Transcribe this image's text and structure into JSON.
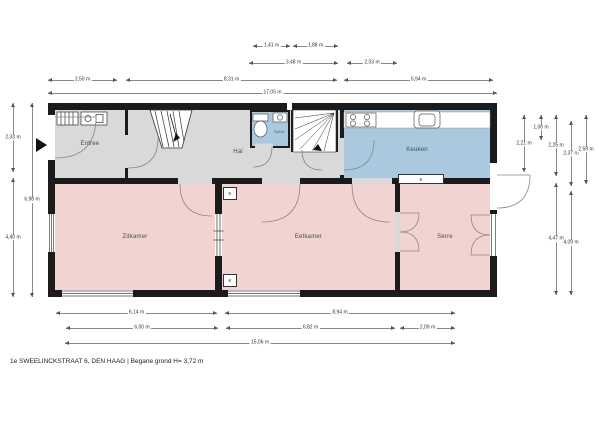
{
  "caption": "1e SWEELINCKSTRAAT 6, DEN HAAG | Begane grond H= 3,72 m",
  "colors": {
    "hall": "#d9d9d9",
    "wet": "#aac9df",
    "living": "#f1d3d1",
    "wall": "#1b1b1b",
    "dim_line": "#888888",
    "dim_text": "#333333",
    "room_text": "#4a4a4a"
  },
  "rooms": [
    {
      "name": "entree",
      "label": "Entree",
      "x": 55,
      "y": 110,
      "w": 70,
      "h": 68,
      "fill": "hall",
      "fs": 6
    },
    {
      "name": "hal",
      "label": "Hal",
      "x": 128,
      "y": 110,
      "w": 212,
      "h": 68,
      "fill": "hall",
      "fs": 6,
      "dx": 4,
      "dy": 8
    },
    {
      "name": "keuken",
      "label": "Keuken",
      "x": 344,
      "y": 110,
      "w": 146,
      "h": 72,
      "fill": "wet",
      "fs": 6,
      "dy": 4
    },
    {
      "name": "toilet",
      "label": "Toilet",
      "x": 250,
      "y": 112,
      "w": 40,
      "h": 35,
      "fill": "wet",
      "fs": 4,
      "dx": 9,
      "dy": 2
    },
    {
      "name": "zitkamer",
      "label": "Zitkamer",
      "x": 55,
      "y": 184,
      "w": 160,
      "h": 106,
      "fill": "living",
      "fs": 6
    },
    {
      "name": "eetkamer",
      "label": "Eetkamer",
      "x": 222,
      "y": 184,
      "w": 173,
      "h": 106,
      "fill": "living",
      "fs": 6
    },
    {
      "name": "serre",
      "label": "Serre",
      "x": 400,
      "y": 184,
      "w": 90,
      "h": 106,
      "fill": "living",
      "fs": 6
    }
  ],
  "markers": [
    {
      "label": "K",
      "x": 398,
      "y": 174,
      "w": 46,
      "h": 10
    },
    {
      "label": "K",
      "x": 223,
      "y": 187,
      "w": 14,
      "h": 13
    },
    {
      "label": "K",
      "x": 223,
      "y": 274,
      "w": 14,
      "h": 13
    }
  ],
  "dimensions": {
    "horizontal": [
      {
        "label": "1,41 m",
        "x1": 253,
        "x2": 290,
        "y": 46
      },
      {
        "label": "1,88 m",
        "x1": 293,
        "x2": 338,
        "y": 46
      },
      {
        "label": "3,48 m",
        "x1": 249,
        "x2": 338,
        "y": 63
      },
      {
        "label": "2,03 m",
        "x1": 347,
        "x2": 397,
        "y": 63
      },
      {
        "label": "2,50 m",
        "x1": 48,
        "x2": 117,
        "y": 80
      },
      {
        "label": "8,31 m",
        "x1": 126,
        "x2": 337,
        "y": 80
      },
      {
        "label": "5,94 m",
        "x1": 344,
        "x2": 493,
        "y": 80
      },
      {
        "label": "17,05 m",
        "x1": 48,
        "x2": 497,
        "y": 93
      },
      {
        "label": "6,14 m",
        "x1": 56,
        "x2": 217,
        "y": 313
      },
      {
        "label": "8,94 m",
        "x1": 225,
        "x2": 455,
        "y": 313
      },
      {
        "label": "6,00 m",
        "x1": 66,
        "x2": 218,
        "y": 328
      },
      {
        "label": "6,82 m",
        "x1": 226,
        "x2": 395,
        "y": 328
      },
      {
        "label": "2,09 m",
        "x1": 400,
        "x2": 455,
        "y": 328
      },
      {
        "label": "15,06 m",
        "x1": 65,
        "x2": 455,
        "y": 343
      }
    ],
    "vertical": [
      {
        "label": "2,33 m",
        "x": 13,
        "y1": 103,
        "y2": 172
      },
      {
        "label": "4,40 m",
        "x": 13,
        "y1": 178,
        "y2": 297
      },
      {
        "label": "6,98 m",
        "x": 32,
        "y1": 103,
        "y2": 297
      },
      {
        "label": "2,21 m",
        "x": 524,
        "y1": 115,
        "y2": 172
      },
      {
        "label": "1,06 m",
        "x": 541,
        "y1": 115,
        "y2": 140
      },
      {
        "label": "2,25 m",
        "x": 556,
        "y1": 115,
        "y2": 176
      },
      {
        "label": "4,47 m",
        "x": 556,
        "y1": 183,
        "y2": 295
      },
      {
        "label": "2,37 m",
        "x": 571,
        "y1": 121,
        "y2": 186
      },
      {
        "label": "4,09 m",
        "x": 571,
        "y1": 191,
        "y2": 295
      },
      {
        "label": "2,59 m",
        "x": 586,
        "y1": 115,
        "y2": 184
      }
    ]
  }
}
